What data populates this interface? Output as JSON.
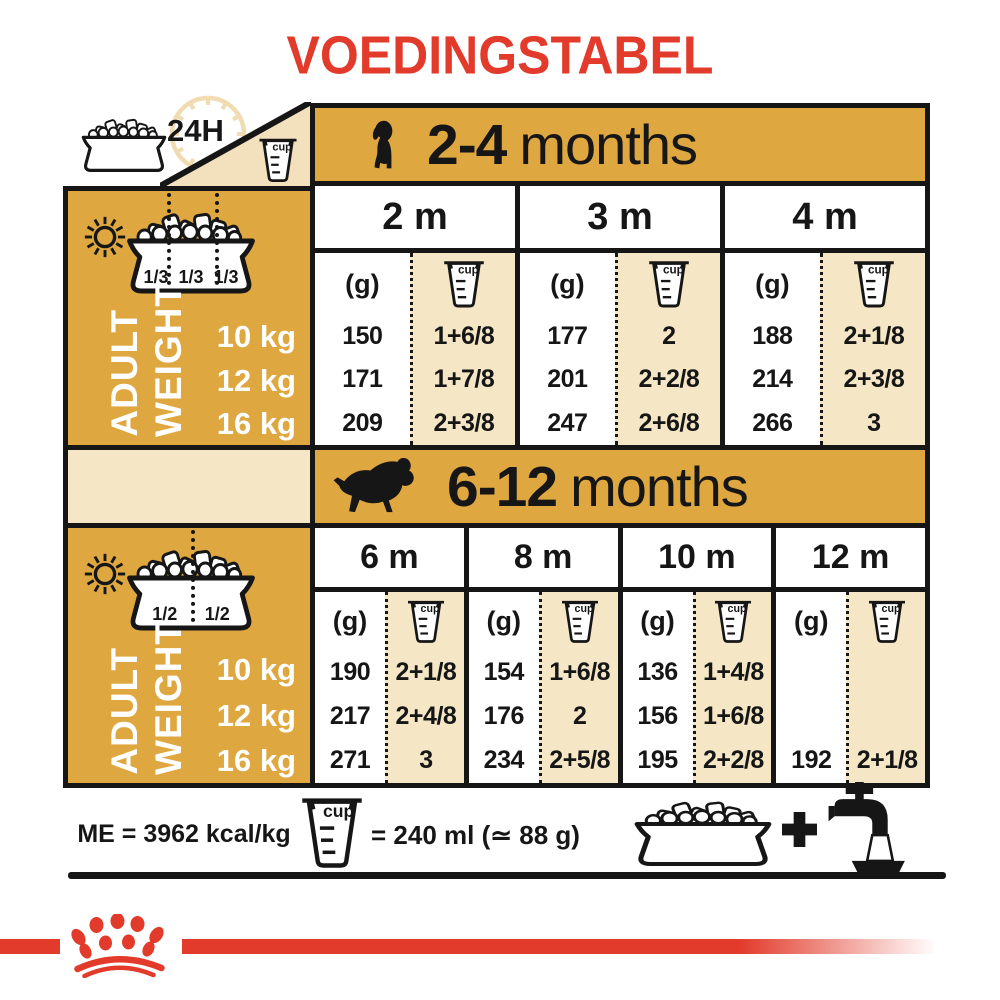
{
  "title": "VOEDINGSTABEL",
  "colors": {
    "red": "#E23B2B",
    "gold": "#DFA740",
    "cream": "#F5E7C6",
    "ink": "#161616"
  },
  "corner": {
    "hours": "24H"
  },
  "labels": {
    "cup_word": "cup",
    "grams_unit": "(g)",
    "adult": "ADULT",
    "weight": "WEIGHT"
  },
  "sections": [
    {
      "age_bold": "2-4",
      "age_rest": "months",
      "fractions": [
        "1/3",
        "1/3",
        "1/3"
      ],
      "weights": [
        "10 kg",
        "12 kg",
        "16 kg"
      ],
      "columns": [
        {
          "month": "2 m",
          "grams": [
            "150",
            "171",
            "209"
          ],
          "cups": [
            "1+6/8",
            "1+7/8",
            "2+3/8"
          ]
        },
        {
          "month": "3 m",
          "grams": [
            "177",
            "201",
            "247"
          ],
          "cups": [
            "2",
            "2+2/8",
            "2+6/8"
          ]
        },
        {
          "month": "4 m",
          "grams": [
            "188",
            "214",
            "266"
          ],
          "cups": [
            "2+1/8",
            "2+3/8",
            "3"
          ]
        }
      ]
    },
    {
      "age_bold": "6-12",
      "age_rest": "months",
      "fractions": [
        "1/2",
        "1/2"
      ],
      "weights": [
        "10 kg",
        "12 kg",
        "16 kg"
      ],
      "columns": [
        {
          "month": "6 m",
          "grams": [
            "190",
            "217",
            "271"
          ],
          "cups": [
            "2+1/8",
            "2+4/8",
            "3"
          ]
        },
        {
          "month": "8 m",
          "grams": [
            "154",
            "176",
            "234"
          ],
          "cups": [
            "1+6/8",
            "2",
            "2+5/8"
          ]
        },
        {
          "month": "10 m",
          "grams": [
            "136",
            "156",
            "195"
          ],
          "cups": [
            "1+4/8",
            "1+6/8",
            "2+2/8"
          ]
        },
        {
          "month": "12 m",
          "grams": [
            "",
            "",
            "192"
          ],
          "cups": [
            "",
            "",
            "2+1/8"
          ]
        }
      ]
    }
  ],
  "legend": {
    "me": "ME = 3962 kcal/kg",
    "cup_equiv": "= 240 ml (≃ 88 g)",
    "plus": "+"
  }
}
